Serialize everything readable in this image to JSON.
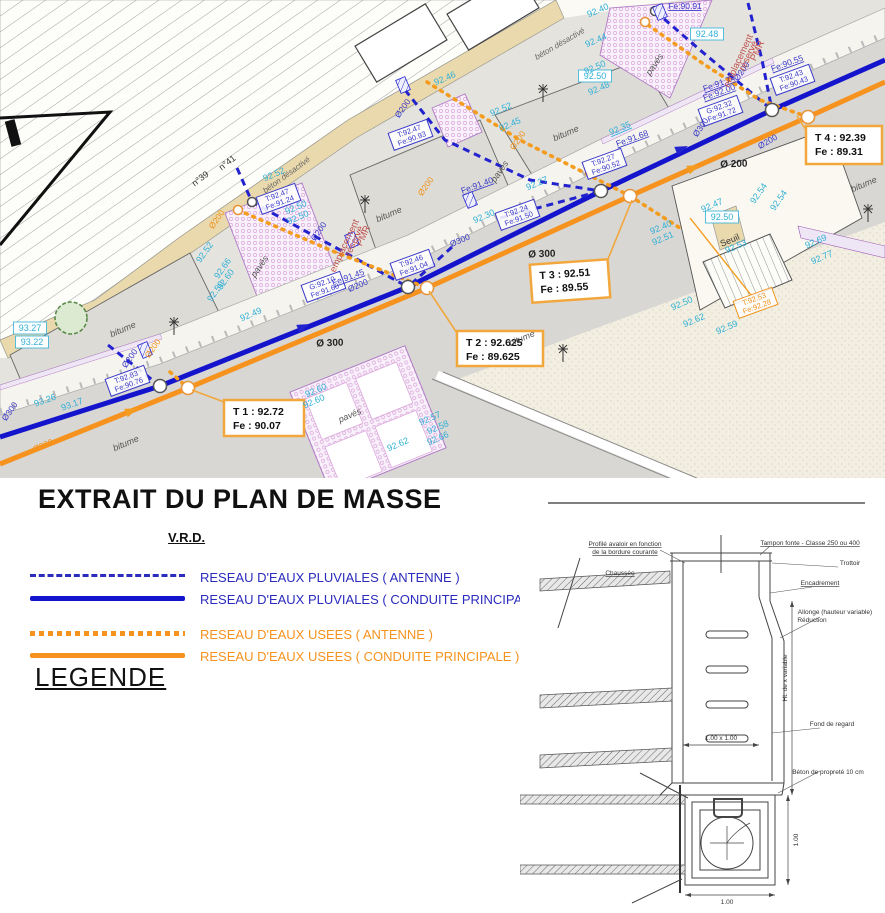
{
  "header": {
    "title": "EXTRAIT DU PLAN DE MASSE",
    "subtitle": "V.R.D.",
    "legend_title": "LEGENDE"
  },
  "legend": {
    "blue": "#2b2bbd",
    "orange": "#f6921e",
    "items": [
      {
        "style": "bdash",
        "color_class": "t-blue",
        "label": "RESEAU D'EAUX PLUVIALES ( ANTENNE )"
      },
      {
        "style": "bsolid",
        "color_class": "t-blue",
        "label": "RESEAU D'EAUX PLUVIALES ( CONDUITE PRINCIPALE )"
      },
      {
        "style": "odot",
        "color_class": "t-orange",
        "label": "RESEAU D'EAUX USEES ( ANTENNE )"
      },
      {
        "style": "osolid",
        "color_class": "t-orange",
        "label": "RESEAU D'EAUX USEES ( CONDUITE PRINCIPALE )"
      }
    ]
  },
  "plan": {
    "labels": [
      {
        "t": "93.27",
        "x": 30,
        "y": 331,
        "c": "lc",
        "box": 1
      },
      {
        "t": "93.22",
        "x": 32,
        "y": 345,
        "c": "lc",
        "box": 1
      },
      {
        "t": "93.26",
        "x": 46,
        "y": 403,
        "c": "lc",
        "r": -20
      },
      {
        "t": "93.17",
        "x": 73,
        "y": 407,
        "c": "lc",
        "r": -20
      },
      {
        "t": "92.52",
        "x": 275,
        "y": 177,
        "c": "lc",
        "r": -23
      },
      {
        "t": "92.50",
        "x": 297,
        "y": 210,
        "c": "lc",
        "r": -23
      },
      {
        "t": "92.50",
        "x": 299,
        "y": 220,
        "c": "lc",
        "r": -23
      },
      {
        "t": "92.52",
        "x": 207,
        "y": 254,
        "c": "lc",
        "r": -55
      },
      {
        "t": "92.66",
        "x": 225,
        "y": 270,
        "c": "lc",
        "r": -55
      },
      {
        "t": "92.60",
        "x": 228,
        "y": 281,
        "c": "lc",
        "r": -55
      },
      {
        "t": "92.50",
        "x": 218,
        "y": 293,
        "c": "lc",
        "r": -55
      },
      {
        "t": "92.49",
        "x": 252,
        "y": 317,
        "c": "lc",
        "r": -23
      },
      {
        "t": "92.60",
        "x": 317,
        "y": 393,
        "c": "lc",
        "r": -23
      },
      {
        "t": "92.60",
        "x": 315,
        "y": 404,
        "c": "lc",
        "r": -23
      },
      {
        "t": "92.62",
        "x": 399,
        "y": 447,
        "c": "lc",
        "r": -23
      },
      {
        "t": "92.57",
        "x": 431,
        "y": 421,
        "c": "lc",
        "r": -23
      },
      {
        "t": "92.58",
        "x": 439,
        "y": 430,
        "c": "lc",
        "r": -23
      },
      {
        "t": "92.66",
        "x": 439,
        "y": 441,
        "c": "lc",
        "r": -23
      },
      {
        "t": "92.46",
        "x": 446,
        "y": 81,
        "c": "lc",
        "r": -23
      },
      {
        "t": "92.50",
        "x": 595,
        "y": 79,
        "c": "lc",
        "box": 1
      },
      {
        "t": "92.48",
        "x": 600,
        "y": 91,
        "c": "lc",
        "r": -23
      },
      {
        "t": "92.52",
        "x": 502,
        "y": 112,
        "c": "lc",
        "r": -23
      },
      {
        "t": "92.45",
        "x": 511,
        "y": 127,
        "c": "lc",
        "r": -23
      },
      {
        "t": "92.35",
        "x": 621,
        "y": 131,
        "c": "lc",
        "u": 1,
        "r": -23
      },
      {
        "t": "92.30",
        "x": 485,
        "y": 219,
        "c": "lc",
        "r": -23
      },
      {
        "t": "92.27",
        "x": 538,
        "y": 186,
        "c": "lc",
        "s": 11,
        "r": -23
      },
      {
        "t": "92.40",
        "x": 662,
        "y": 230,
        "c": "lc",
        "r": -23
      },
      {
        "t": "92.51",
        "x": 664,
        "y": 241,
        "c": "lc",
        "r": -23
      },
      {
        "t": "92.47",
        "x": 713,
        "y": 208,
        "c": "lc",
        "r": -23
      },
      {
        "t": "92.50",
        "x": 722,
        "y": 220,
        "c": "lc",
        "box": 1
      },
      {
        "t": "92.54",
        "x": 761,
        "y": 195,
        "c": "lc",
        "r": -55
      },
      {
        "t": "92.53",
        "x": 737,
        "y": 249,
        "c": "lc",
        "r": -23
      },
      {
        "t": "92.69",
        "x": 817,
        "y": 244,
        "c": "lc",
        "r": -23
      },
      {
        "t": "92.77",
        "x": 823,
        "y": 260,
        "c": "lc",
        "r": -23
      },
      {
        "t": "92.50",
        "x": 683,
        "y": 306,
        "c": "lc",
        "r": -23
      },
      {
        "t": "92.62",
        "x": 695,
        "y": 323,
        "c": "lc",
        "r": -23
      },
      {
        "t": "92.59",
        "x": 728,
        "y": 330,
        "c": "lc",
        "r": -23
      },
      {
        "t": "92.54",
        "x": 781,
        "y": 202,
        "c": "lc",
        "r": -55
      },
      {
        "t": "92.48",
        "x": 707,
        "y": 37,
        "c": "lc",
        "box": 1
      },
      {
        "t": "92.40",
        "x": 599,
        "y": 13,
        "c": "lc",
        "r": -23
      },
      {
        "t": "92.44",
        "x": 597,
        "y": 43,
        "c": "lc",
        "r": -23
      },
      {
        "t": "92.50",
        "x": 596,
        "y": 70,
        "c": "lc",
        "r": -23
      },
      {
        "t": "Fe:91.40",
        "x": 478,
        "y": 188,
        "c": "lb",
        "u": 1,
        "r": -20
      },
      {
        "t": "Fe:91.68",
        "x": 633,
        "y": 141,
        "c": "lb",
        "u": 1,
        "r": -20
      },
      {
        "t": "Fe:91.74",
        "x": 720,
        "y": 86,
        "c": "lb",
        "u": 1,
        "r": -20
      },
      {
        "t": "Fe:92.00",
        "x": 720,
        "y": 95,
        "c": "lb",
        "u": 1,
        "r": -20
      },
      {
        "t": "Fe:90.55",
        "x": 788,
        "y": 66,
        "c": "lb",
        "u": 1,
        "r": -20
      },
      {
        "t": "Fe:90.91",
        "x": 685,
        "y": 9,
        "c": "lb",
        "u": 1
      },
      {
        "t": "Fe:91.45",
        "x": 349,
        "y": 280,
        "c": "lb",
        "u": 1,
        "r": -20
      },
      {
        "t": "Ø300",
        "x": 12,
        "y": 413,
        "c": "lb",
        "r": -55
      },
      {
        "t": "Ø200",
        "x": 132,
        "y": 360,
        "c": "lb",
        "r": -55
      },
      {
        "t": "Ø200",
        "x": 321,
        "y": 233,
        "c": "lb",
        "r": -55
      },
      {
        "t": "Ø200",
        "x": 405,
        "y": 110,
        "c": "lb",
        "r": -55
      },
      {
        "t": "Ø200",
        "x": 744,
        "y": 73,
        "c": "lb",
        "r": -55
      },
      {
        "t": "Ø300",
        "x": 703,
        "y": 129,
        "c": "lb",
        "r": -55
      },
      {
        "t": "Ø200",
        "x": 769,
        "y": 144,
        "c": "lb",
        "r": -30
      },
      {
        "t": "Ø200",
        "x": 359,
        "y": 288,
        "c": "lb",
        "r": -23
      },
      {
        "t": "Ø300",
        "x": 461,
        "y": 243,
        "c": "lb",
        "r": -23
      },
      {
        "t": "Ø200",
        "x": 44,
        "y": 448,
        "c": "lo",
        "r": -23
      },
      {
        "t": "Ø200",
        "x": 155,
        "y": 350,
        "c": "lo",
        "r": -55
      },
      {
        "t": "Ø200",
        "x": 219,
        "y": 221,
        "c": "lo",
        "r": -55
      },
      {
        "t": "Ø200",
        "x": 520,
        "y": 142,
        "c": "lo",
        "r": -55
      },
      {
        "t": "Ø200",
        "x": 428,
        "y": 188,
        "c": "lo",
        "r": -55
      },
      {
        "t": "Ø 300",
        "x": 330,
        "y": 346,
        "c": "lk",
        "r": -2
      },
      {
        "t": "Ø 300",
        "x": 542,
        "y": 257,
        "c": "lk",
        "r": -2
      },
      {
        "t": "Ø 200",
        "x": 734,
        "y": 167,
        "c": "lk",
        "r": -2
      },
      {
        "t": "bitume",
        "x": 124,
        "y": 332,
        "c": "li",
        "r": -23
      },
      {
        "t": "bitume",
        "x": 390,
        "y": 217,
        "c": "li",
        "r": -23
      },
      {
        "t": "bitume",
        "x": 567,
        "y": 136,
        "c": "li",
        "r": -23
      },
      {
        "t": "bitume",
        "x": 865,
        "y": 187,
        "c": "li",
        "r": -23
      },
      {
        "t": "bitume",
        "x": 127,
        "y": 446,
        "c": "li",
        "r": -23
      },
      {
        "t": "bitume",
        "x": 523,
        "y": 341,
        "c": "li",
        "r": -23
      },
      {
        "t": "pavés",
        "x": 262,
        "y": 268,
        "c": "li",
        "r": -55
      },
      {
        "t": "pavés",
        "x": 657,
        "y": 66,
        "c": "li",
        "r": -55
      },
      {
        "t": "pavés",
        "x": 502,
        "y": 173,
        "c": "li",
        "r": -55
      },
      {
        "t": "pavés",
        "x": 351,
        "y": 418,
        "c": "li",
        "r": -23
      },
      {
        "t": "Seuil",
        "x": 731,
        "y": 243,
        "c": "ln",
        "r": -23
      },
      {
        "t": "n°39",
        "x": 202,
        "y": 181,
        "c": "ln",
        "r": -37
      },
      {
        "t": "n°41",
        "x": 229,
        "y": 165,
        "c": "ln",
        "r": -37
      },
      {
        "t": "béton désactivé",
        "x": 288,
        "y": 177,
        "c": "lbd",
        "r": -36
      },
      {
        "t": "béton désactivé",
        "x": 561,
        "y": 46,
        "c": "lbd",
        "r": -30
      },
      {
        "t": "emplacement",
        "x": 347,
        "y": 247,
        "c": "lr",
        "r": -65
      },
      {
        "t": "réservé",
        "x": 357,
        "y": 242,
        "c": "lr",
        "r": -65
      },
      {
        "t": "PMR",
        "x": 366,
        "y": 237,
        "c": "lr",
        "r": -65
      },
      {
        "t": "emplacement",
        "x": 741,
        "y": 62,
        "c": "lr",
        "r": -65
      },
      {
        "t": "réservé",
        "x": 751,
        "y": 57,
        "c": "lr",
        "r": -65
      },
      {
        "t": "PMR",
        "x": 760,
        "y": 52,
        "c": "lr",
        "r": -65
      }
    ],
    "blue_boxes": [
      {
        "l1": "T:92.83",
        "l2": "Fe:90.76",
        "x": 107,
        "y": 372
      },
      {
        "l1": "T:92.47",
        "l2": "Fe:91.24",
        "x": 258,
        "y": 190
      },
      {
        "l1": "T:92.47",
        "l2": "Fe:90.93",
        "x": 390,
        "y": 126
      },
      {
        "l1": "T:92.46",
        "l2": "Fe:91.04",
        "x": 392,
        "y": 256
      },
      {
        "l1": "G:92.10",
        "l2": "Fe:91.60",
        "x": 303,
        "y": 278
      },
      {
        "l1": "T:92.24",
        "l2": "Fe:91.50",
        "x": 497,
        "y": 206
      },
      {
        "l1": "T:92.27",
        "l2": "Fe:90.52",
        "x": 584,
        "y": 155
      },
      {
        "l1": "G:92.32",
        "l2": "Fe:91.72",
        "x": 700,
        "y": 102
      },
      {
        "l1": "T:92.43",
        "l2": "Fe:90.43",
        "x": 772,
        "y": 71
      },
      {
        "l1": "T:92.53",
        "l2": "Fe:92.28",
        "x": 735,
        "y": 294,
        "col": "o"
      }
    ],
    "t_boxes": [
      {
        "l1": "T 1 : 92.72",
        "l2": "Fe : 90.07",
        "x": 224,
        "y": 400,
        "w": 80,
        "h": 36,
        "lead": [
          224,
          402,
          192,
          390
        ]
      },
      {
        "l1": "T 2 : 92.625",
        "l2": "Fe : 89.625",
        "x": 457,
        "y": 331,
        "w": 86,
        "h": 35,
        "lead": [
          457,
          333,
          429,
          291
        ]
      },
      {
        "l1": "T 3 : 92.51",
        "l2": "Fe : 89.55",
        "x": 531,
        "y": 262,
        "w": 78,
        "h": 38,
        "rot": -4,
        "lead": [
          606,
          264,
          632,
          200
        ]
      },
      {
        "l1": "T 4 : 92.39",
        "l2": "Fe : 89.31",
        "x": 806,
        "y": 126,
        "w": 76,
        "h": 38,
        "lead": [
          806,
          130,
          797,
          116
        ]
      }
    ],
    "pipes": {
      "blue_main": [
        [
          0,
          437
        ],
        [
          160,
          386
        ],
        [
          408,
          287
        ],
        [
          601,
          191
        ],
        [
          772,
          110
        ],
        [
          885,
          60
        ]
      ],
      "orange_main": [
        [
          0,
          464
        ],
        [
          188,
          388
        ],
        [
          427,
          288
        ],
        [
          630,
          196
        ],
        [
          808,
          117
        ],
        [
          885,
          82
        ]
      ],
      "blue_antennas": [
        [
          [
            108,
            345
          ],
          [
            160,
            386
          ]
        ],
        [
          [
            237,
            168
          ],
          [
            252,
            202
          ],
          [
            408,
            287
          ]
        ],
        [
          [
            452,
            247
          ],
          [
            408,
            287
          ]
        ],
        [
          [
            405,
            90
          ],
          [
            445,
            140
          ],
          [
            530,
            180
          ],
          [
            601,
            191
          ]
        ],
        [
          [
            500,
            218
          ],
          [
            601,
            191
          ]
        ],
        [
          [
            655,
            11
          ],
          [
            700,
            50
          ],
          [
            772,
            110
          ]
        ],
        [
          [
            748,
            3
          ],
          [
            762,
            60
          ],
          [
            772,
            110
          ]
        ]
      ],
      "orange_antennas": [
        [
          [
            170,
            372
          ],
          [
            188,
            388
          ]
        ],
        [
          [
            238,
            210
          ],
          [
            330,
            250
          ],
          [
            427,
            288
          ]
        ],
        [
          [
            427,
            82
          ],
          [
            520,
            140
          ],
          [
            630,
            196
          ]
        ],
        [
          [
            648,
            25
          ],
          [
            705,
            65
          ],
          [
            760,
            100
          ],
          [
            808,
            117
          ]
        ],
        [
          [
            630,
            196
          ],
          [
            680,
            228
          ]
        ]
      ],
      "orange_leaders": [
        [
          690,
          218,
          755,
          300
        ]
      ]
    },
    "manholes": {
      "blue": [
        [
          160,
          386
        ],
        [
          408,
          287
        ],
        [
          601,
          191
        ],
        [
          772,
          110
        ],
        [
          252,
          202
        ],
        [
          655,
          11
        ]
      ],
      "orange": [
        [
          188,
          388
        ],
        [
          427,
          288
        ],
        [
          630,
          196
        ],
        [
          808,
          117
        ],
        [
          238,
          210
        ],
        [
          645,
          22
        ]
      ]
    },
    "symbols": {
      "gullies": [
        [
          145,
          350
        ],
        [
          352,
          240
        ],
        [
          470,
          200
        ],
        [
          660,
          12
        ],
        [
          403,
          85
        ]
      ],
      "lampposts": [
        [
          174,
          322
        ],
        [
          365,
          200
        ],
        [
          543,
          89
        ],
        [
          868,
          209
        ],
        [
          563,
          349
        ]
      ],
      "tree": [
        71,
        318
      ],
      "blue_arrows": [
        [
          310,
          324
        ],
        [
          688,
          146
        ]
      ],
      "orange_arrows": [
        [
          138,
          408
        ],
        [
          700,
          165
        ]
      ]
    }
  },
  "detail": {
    "title": "Regard avaloir 100x100 - Avaloir profil AT",
    "scale": "Ech : 1/20",
    "labels": [
      {
        "t": "Profilé avaloir en fonction",
        "x": 105,
        "y": 63,
        "u": 1
      },
      {
        "t": "de la bordure courante",
        "x": 105,
        "y": 71,
        "u": 1
      },
      {
        "t": "Chaussée",
        "x": 100,
        "y": 92,
        "u": 1
      },
      {
        "t": "Tampon fonte - Classe 250 ou 400",
        "x": 290,
        "y": 62,
        "u": 1
      },
      {
        "t": "Trottoir",
        "x": 330,
        "y": 82
      },
      {
        "t": "Encadrement",
        "x": 300,
        "y": 102,
        "u": 1
      },
      {
        "t": "Allonge (hauteur variable)",
        "x": 315,
        "y": 131
      },
      {
        "t": "Réduction",
        "x": 292,
        "y": 139
      },
      {
        "t": "Ht. de x variable",
        "x": 267,
        "y": 195,
        "r": -90
      },
      {
        "t": "1.00 x 1.00",
        "x": 201,
        "y": 257
      },
      {
        "t": "Fond de regard",
        "x": 312,
        "y": 243
      },
      {
        "t": "Béton de propreté 10 cm",
        "x": 308,
        "y": 291
      },
      {
        "t": "1.00",
        "x": 207,
        "y": 421
      },
      {
        "t": "1.00",
        "x": 278,
        "y": 357,
        "r": -90
      }
    ]
  }
}
